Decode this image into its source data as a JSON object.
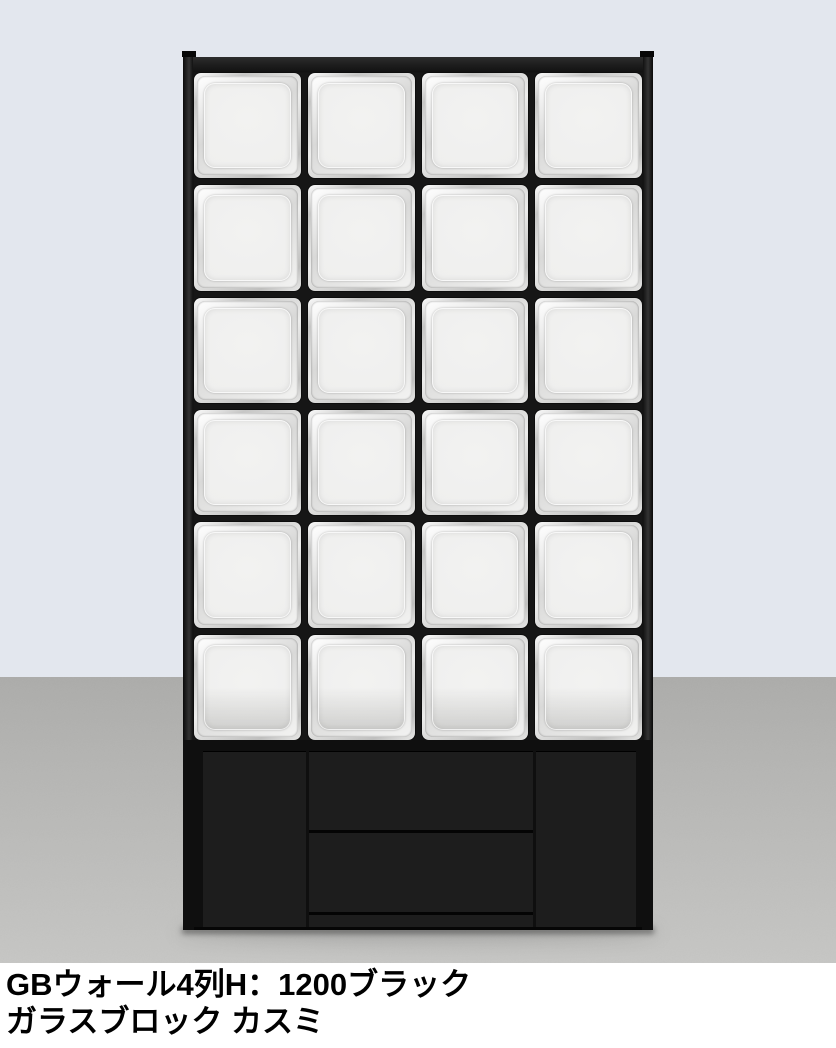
{
  "caption": {
    "line1": "GBウォール4列H：1200ブラック",
    "line2": "ガラスブロック カスミ"
  },
  "product": {
    "grid": {
      "columns": 4,
      "rows": 6
    },
    "colors": {
      "frame": "#1a1a1a",
      "glass_face": "#f2f2f1"
    }
  },
  "scene": {
    "wall_color": "#e3e7ee",
    "floor_color": "#b7b7b5",
    "caption_bg": "#ffffff",
    "text_color": "#000000"
  }
}
